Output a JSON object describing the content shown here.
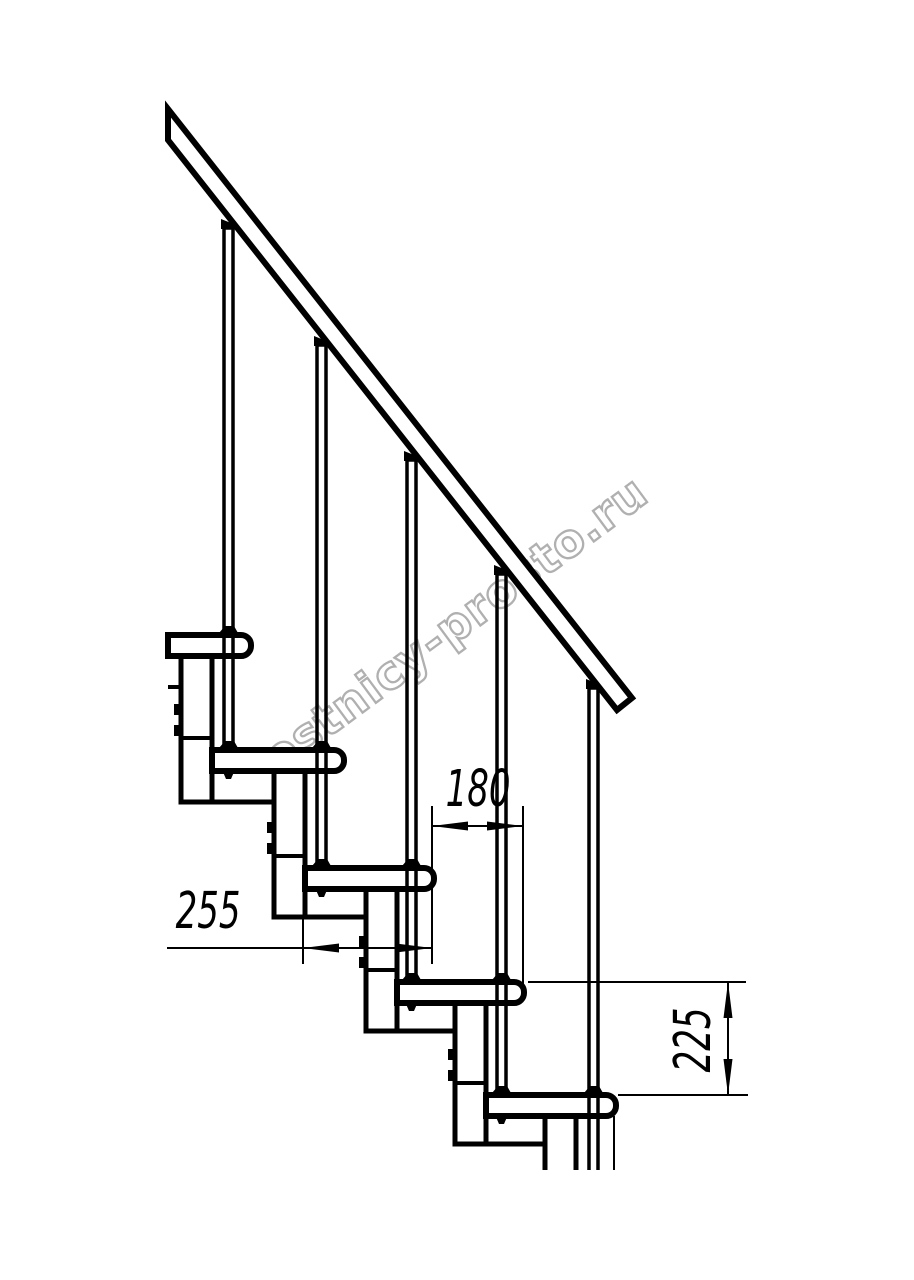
{
  "drawing": {
    "watermark": "lestnicy-prosto.ru",
    "dimensions": [
      {
        "id": "step-going",
        "label": "180",
        "orientation": "horizontal"
      },
      {
        "id": "tread-depth",
        "label": "255",
        "orientation": "horizontal"
      },
      {
        "id": "step-rise",
        "label": "225",
        "orientation": "vertical"
      }
    ],
    "structure": {
      "treads_visible": 5,
      "balusters_visible": 5
    },
    "colors": {
      "line": "#000000",
      "dimension_text": "#000000",
      "watermark_outline": "#b0b0b0",
      "background": "#ffffff"
    }
  }
}
